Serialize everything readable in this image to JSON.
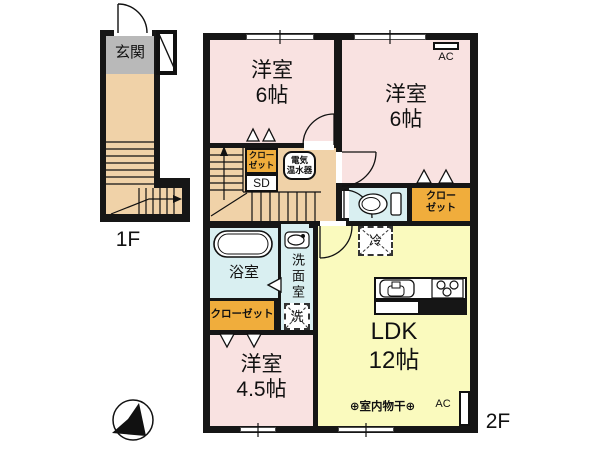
{
  "plan": {
    "floor_labels": {
      "first": "1F",
      "second": "2F"
    },
    "colors": {
      "wall": "#161616",
      "western_room": "#f9e2e1",
      "ldk": "#fafabe",
      "hallway_stairs": "#f0d2a8",
      "wet_area": "#d9eff1",
      "closet": "#f0ad3c",
      "genkan": "#b9b9b9"
    },
    "rooms": {
      "genkan": {
        "label": "玄関"
      },
      "western_nw": {
        "name": "洋室",
        "size": "6帖"
      },
      "western_ne": {
        "name": "洋室",
        "size": "6帖"
      },
      "western_s": {
        "name": "洋室",
        "size": "4.5帖"
      },
      "ldk": {
        "name": "LDK",
        "size": "12帖"
      },
      "bath": {
        "label": "浴室"
      },
      "washroom": {
        "label": "洗面室"
      },
      "washer": {
        "label": "洗"
      },
      "fridge": {
        "label": "冷"
      },
      "closet_hall": {
        "line1": "クロー",
        "line2": "ゼット"
      },
      "sliding_door": {
        "label": "SD"
      },
      "water_heater": {
        "line1": "電気",
        "line2": "温水器"
      },
      "closet_ne": {
        "line1": "クロー",
        "line2": "ゼット"
      },
      "closet_bath": {
        "label": "クローゼット"
      }
    },
    "equipment": {
      "ac_top": "AC",
      "ac_bottom": "AC",
      "indoor_drying": "⊕室内物干⊕"
    }
  }
}
